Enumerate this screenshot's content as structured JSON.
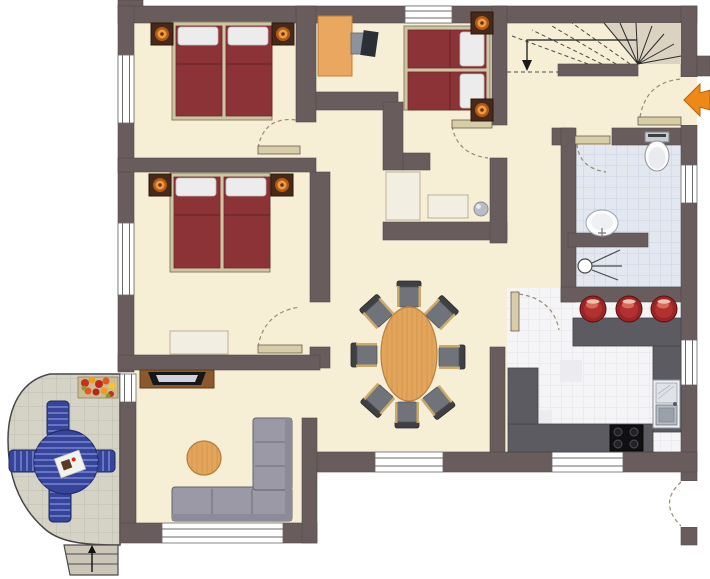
{
  "plan": {
    "kind": "residential-floor-plan",
    "counts": {
      "bedrooms": 3,
      "dining_chairs": 8,
      "bar_stools": 3,
      "patio_chairs": 4,
      "beds": 3,
      "exterior_windows": 9,
      "interior_doors": 5
    }
  },
  "colors": {
    "wall": "#695c5d",
    "wall_edge": "#4f4546",
    "floor": "#f6efd6",
    "bath_floor": "#e2e7f0",
    "bath_grid": "#c9d1e2",
    "kitchen_floor": "#f5f5f7",
    "kitchen_grid": "#e2e2e8",
    "patio_floor": "#d5d2c6",
    "patio_grid": "#bfbcb1",
    "counter": "#5c5b62",
    "bed": "#8c3337",
    "bed_seam": "#6e2629",
    "bed_frame": "#cfc4a4",
    "pillow": "#ececec",
    "nightstand": "#46291a",
    "lamp_ring": "#b35a12",
    "lamp_glow": "#ef9d45",
    "wood": "#e2a55b",
    "wood_grain": "#c98f46",
    "wood_dark": "#8a5a2e",
    "sofa": "#9b99a6",
    "sofa_line": "#6f6d7c",
    "chair_seat": "#70737a",
    "chair_back": "#3e4044",
    "chair_trim": "#c9aa6b",
    "patio_set": "#36459a",
    "patio_stripe": "#6874c4",
    "stool": "#9c2424",
    "accent_orange": "#ee8816",
    "wardrobe": "#e9a75f",
    "door_leaf": "#d8cda9",
    "door_arc": "#9a8b73",
    "white_furniture": "#f2efe2",
    "window_line": "#6a6a6a",
    "stair_fill": "#dbd2c2",
    "step_fill": "#ccc6b8"
  },
  "items": {
    "bedroom1_bed": "double bed",
    "bedroom2_bed": "double bed",
    "bedroom3_bed": "double bed",
    "nightstand": "nightstand with lamp",
    "wardrobe": "wardrobe",
    "closet": "built-in closet",
    "vase": "plant vase",
    "dresser": "dresser",
    "tv_board": "TV sideboard",
    "sofa": "corner sofa",
    "coffee_table": "round coffee table",
    "dining_table": "oval dining table",
    "dining_chair": "dining chair",
    "patio_table": "round patio table",
    "patio_chair": "patio chair",
    "flower_box": "flower box",
    "stairs": "staircase to upper floor",
    "entrance_arrow": "entrance marker",
    "toilet": "toilet",
    "washbasin": "washbasin",
    "shower": "shower",
    "bar_stool": "bar stool",
    "counter": "kitchen counter",
    "kitchen_sink": "kitchen sink",
    "cooktop": "cooktop",
    "door": "door",
    "window": "window",
    "steps": "patio steps"
  }
}
